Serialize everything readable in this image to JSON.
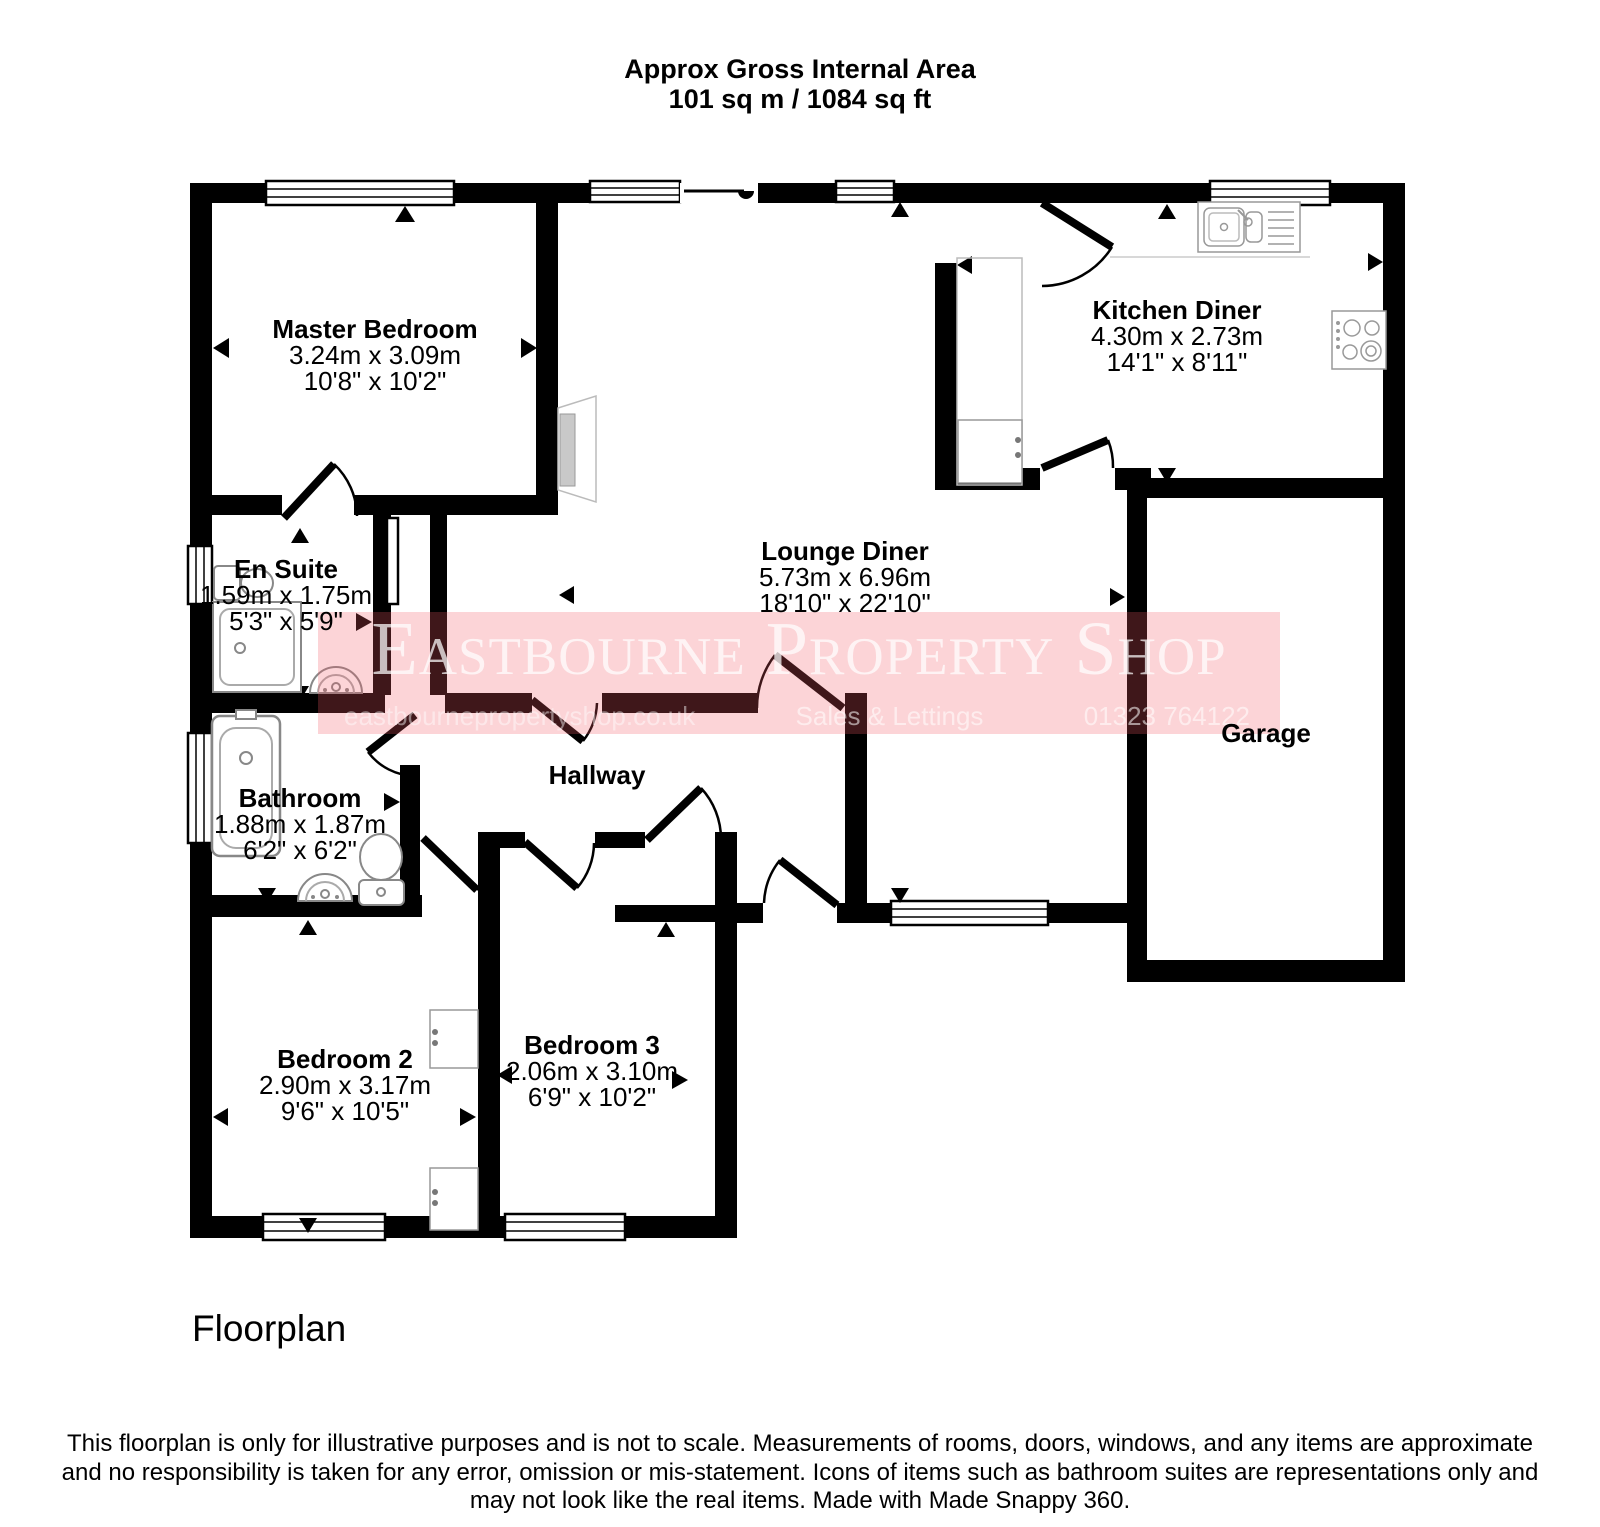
{
  "header": {
    "line1": "Approx Gross Internal Area",
    "line2": "101 sq m / 1084 sq ft"
  },
  "watermark": {
    "title": "Eastbourne Property Shop",
    "url": "eastbournepropertyshop.co.uk",
    "tagline": "Sales & Lettings",
    "phone": "01323 764122",
    "band_color": "rgba(242,90,102,0.26)"
  },
  "rooms": [
    {
      "id": "master-bedroom",
      "name": "Master Bedroom",
      "dim_metric": "3.24m x 3.09m",
      "dim_imperial": "10'8\" x 10'2\"",
      "cx": 375,
      "ty": 316
    },
    {
      "id": "en-suite",
      "name": "En Suite",
      "dim_metric": "1.59m x 1.75m",
      "dim_imperial": "5'3\" x 5'9\"",
      "cx": 286,
      "ty": 556
    },
    {
      "id": "bathroom",
      "name": "Bathroom",
      "dim_metric": "1.88m x 1.87m",
      "dim_imperial": "6'2\" x 6'2\"",
      "cx": 300,
      "ty": 785
    },
    {
      "id": "bedroom-2",
      "name": "Bedroom 2",
      "dim_metric": "2.90m x 3.17m",
      "dim_imperial": "9'6\" x 10'5\"",
      "cx": 345,
      "ty": 1046
    },
    {
      "id": "bedroom-3",
      "name": "Bedroom 3",
      "dim_metric": "2.06m x 3.10m",
      "dim_imperial": "6'9\" x 10'2\"",
      "cx": 592,
      "ty": 1032
    },
    {
      "id": "lounge-diner",
      "name": "Lounge Diner",
      "dim_metric": "5.73m x 6.96m",
      "dim_imperial": "18'10\" x 22'10\"",
      "cx": 845,
      "ty": 538
    },
    {
      "id": "kitchen-diner",
      "name": "Kitchen Diner",
      "dim_metric": "4.30m x 2.73m",
      "dim_imperial": "14'1\" x 8'11\"",
      "cx": 1177,
      "ty": 297
    },
    {
      "id": "hallway",
      "name": "Hallway",
      "cx": 597,
      "ty": 762
    },
    {
      "id": "garage",
      "name": "Garage",
      "cx": 1266,
      "ty": 720
    }
  ],
  "footer": {
    "caption": "Floorplan",
    "disclaimer": [
      "This floorplan is only for illustrative purposes and is not to scale. Measurements of rooms, doors, windows, and any items are approximate",
      "and no responsibility is taken for any error, omission or mis-statement. Icons of items such as bathroom suites are representations only and",
      "may not look like the real items. Made with Made Snappy 360."
    ]
  }
}
